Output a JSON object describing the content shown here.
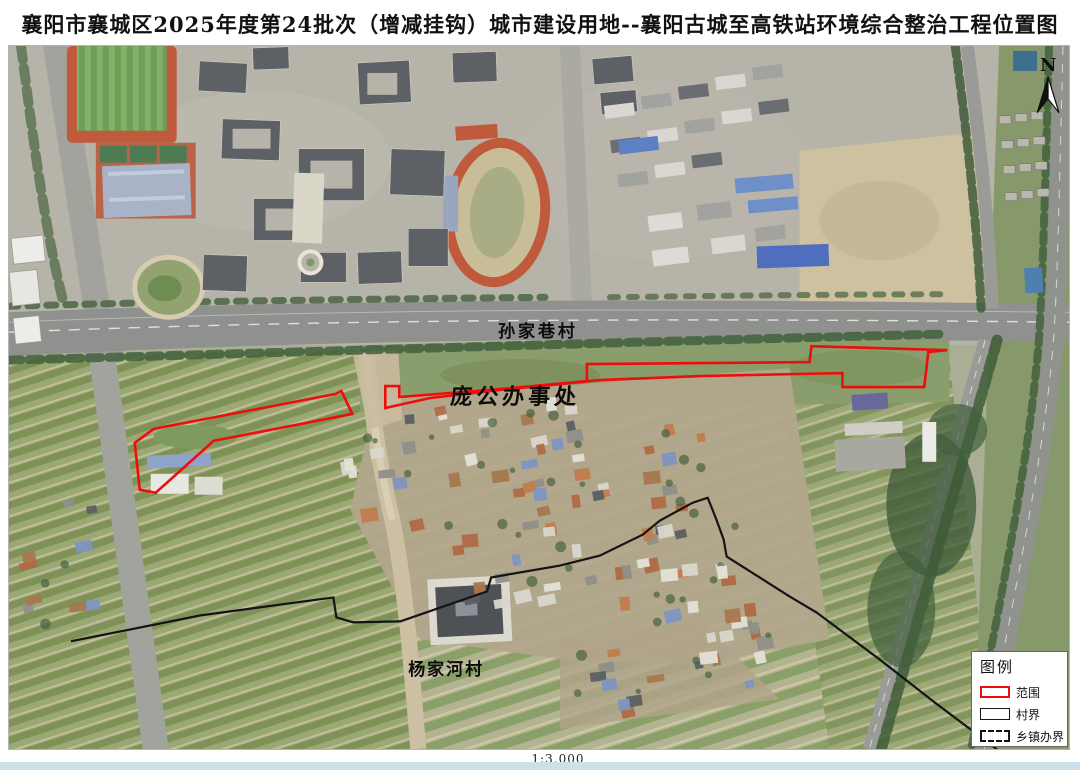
{
  "title": "襄阳市襄城区2025年度第24批次（增减挂钩）城市建设用地--襄阳古城至高铁站环境综合整治工程位置图",
  "map": {
    "labels": {
      "sunjiaxiang": "孙家巷村",
      "panggong": "庞公办事处",
      "yangjiahe": "杨家河村"
    },
    "north_label": "N",
    "scale_text": "1:3,000"
  },
  "legend": {
    "title": "图例",
    "items": [
      {
        "label": "范围"
      },
      {
        "label": "村界"
      },
      {
        "label": "乡镇办界"
      }
    ]
  },
  "colors": {
    "range_red": "#ee0d0d",
    "village_boundary": "#141414",
    "bottom_bar": "#cfdfe9"
  }
}
